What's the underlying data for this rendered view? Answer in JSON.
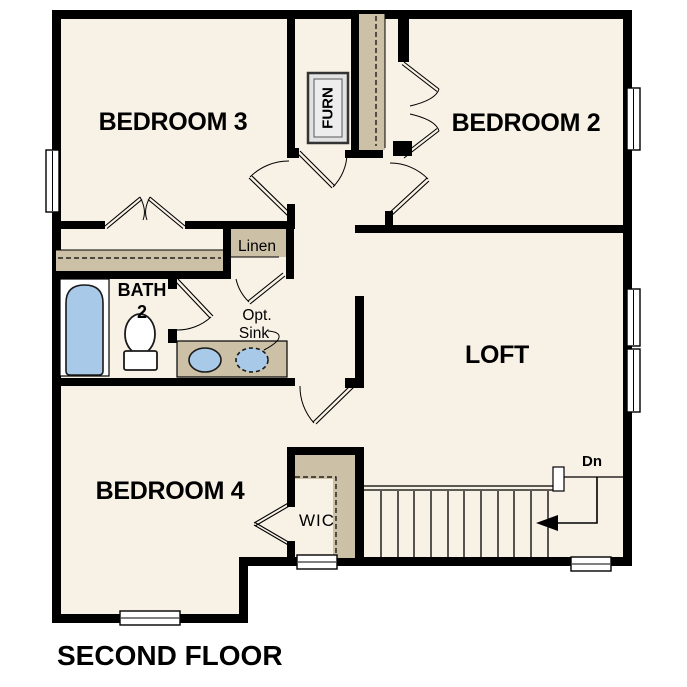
{
  "plan": {
    "title": "SECOND FLOOR",
    "labels": {
      "bedroom3": "BEDROOM 3",
      "bedroom2": "BEDROOM 2",
      "bedroom4": "BEDROOM 4",
      "loft": "LOFT",
      "bath_line1": "BATH",
      "bath_line2": "2",
      "linen": "Linen",
      "furnace": "FURN",
      "opt_sink_line1": "Opt.",
      "opt_sink_line2": "Sink",
      "wic": "WIC",
      "stairs_down": "Dn"
    },
    "colors": {
      "floor": "#f8f1e6",
      "closet": "#ccc0a6",
      "fixture_blue": "#a9c9e9",
      "wall": "#000000",
      "furnace_gray": "#e4e4e4"
    }
  }
}
